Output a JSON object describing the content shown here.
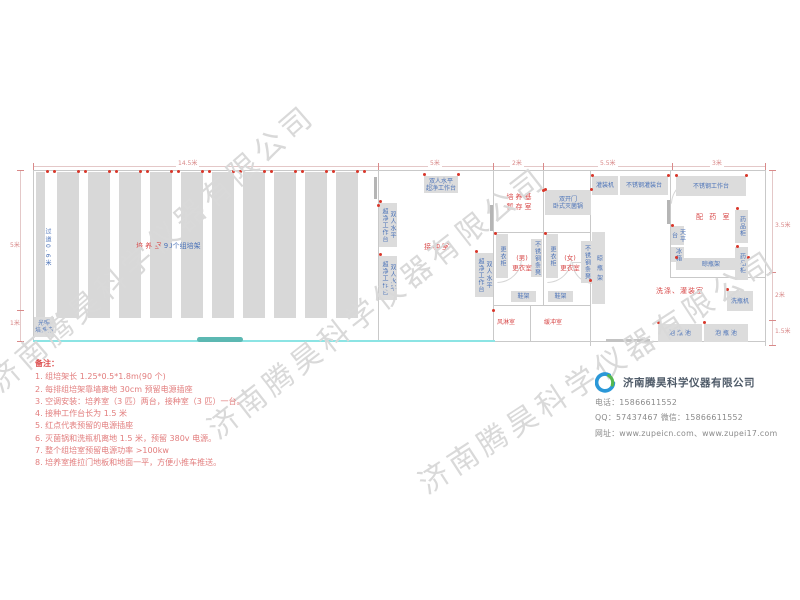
{
  "watermark": {
    "text": "济南腾昊科学仪器有限公司",
    "color": "#d9d9d9",
    "instances": [
      {
        "x": -8,
        "y": 362,
        "angle": -41
      },
      {
        "x": 210,
        "y": 408,
        "angle": -38
      },
      {
        "x": 420,
        "y": 462,
        "angle": -33
      }
    ]
  },
  "plan": {
    "wall_color": "#c9c9c9",
    "walls": [
      {
        "x": 33,
        "y": 170,
        "w": 733,
        "h": 1
      },
      {
        "x": 33,
        "y": 170,
        "w": 1,
        "h": 172
      },
      {
        "x": 765,
        "y": 170,
        "w": 1,
        "h": 176
      },
      {
        "x": 493,
        "y": 341,
        "w": 273,
        "h": 1
      },
      {
        "x": 378,
        "y": 170,
        "w": 1,
        "h": 172
      },
      {
        "x": 493,
        "y": 170,
        "w": 1,
        "h": 172
      },
      {
        "x": 543,
        "y": 170,
        "w": 1,
        "h": 136
      },
      {
        "x": 590,
        "y": 170,
        "w": 1,
        "h": 176
      },
      {
        "x": 670,
        "y": 170,
        "w": 1,
        "h": 108
      },
      {
        "x": 493,
        "y": 232,
        "w": 98,
        "h": 1
      },
      {
        "x": 670,
        "y": 277,
        "w": 96,
        "h": 1
      },
      {
        "x": 493,
        "y": 305,
        "w": 98,
        "h": 1
      },
      {
        "x": 530,
        "y": 305,
        "w": 1,
        "h": 37
      },
      {
        "x": 374,
        "y": 177,
        "w": 3,
        "h": 22,
        "c": "#b5b5b5"
      },
      {
        "x": 490,
        "y": 205,
        "w": 3,
        "h": 26,
        "c": "#b5b5b5"
      },
      {
        "x": 667,
        "y": 200,
        "w": 3,
        "h": 24,
        "c": "#b5b5b5"
      },
      {
        "x": 606,
        "y": 339,
        "w": 44,
        "h": 3,
        "c": "#c3c3c3"
      }
    ],
    "racks": {
      "y": 172,
      "h": 146,
      "color": "#d8d8d8",
      "bars": [
        {
          "x": 36,
          "w": 9
        },
        {
          "x": 57,
          "w": 22
        },
        {
          "x": 88,
          "w": 22
        },
        {
          "x": 119,
          "w": 22
        },
        {
          "x": 150,
          "w": 22
        },
        {
          "x": 181,
          "w": 22
        },
        {
          "x": 212,
          "w": 22
        },
        {
          "x": 243,
          "w": 22
        },
        {
          "x": 274,
          "w": 22
        },
        {
          "x": 305,
          "w": 22
        },
        {
          "x": 336,
          "w": 22
        }
      ]
    },
    "cyan_line": {
      "x": 33,
      "y": 340,
      "w": 462,
      "h": 2,
      "color": "#8ce4e4"
    },
    "door_slide": {
      "x": 197,
      "y": 337,
      "w": 46,
      "h": 5,
      "color": "#5cb8b2"
    },
    "outlet_color": "#d9372b",
    "outlets_top_xs": [
      50,
      81,
      112,
      143,
      174,
      205,
      236,
      267,
      298,
      329,
      360
    ],
    "outlet_dots": [
      [
        380,
        201
      ],
      [
        380,
        254
      ],
      [
        476,
        251
      ],
      [
        424,
        174
      ],
      [
        458,
        174
      ],
      [
        545,
        189
      ],
      [
        591,
        189
      ],
      [
        495,
        233
      ],
      [
        545,
        233
      ],
      [
        592,
        175
      ],
      [
        668,
        175
      ],
      [
        676,
        175
      ],
      [
        746,
        175
      ],
      [
        672,
        225
      ],
      [
        737,
        208
      ],
      [
        737,
        246
      ],
      [
        676,
        257
      ],
      [
        748,
        257
      ],
      [
        727,
        289
      ],
      [
        658,
        322
      ],
      [
        704,
        322
      ],
      [
        543,
        190
      ],
      [
        378,
        205
      ],
      [
        493,
        310
      ],
      [
        590,
        280
      ]
    ],
    "equipment_color": "#dcdcdc",
    "equipment_text_color": "#4a72b8",
    "equipment_h": [
      {
        "x": 424,
        "y": 176,
        "w": 34,
        "h": 17,
        "lines": [
          "双人水平",
          "超净工作台"
        ]
      },
      {
        "x": 545,
        "y": 190,
        "w": 46,
        "h": 25,
        "lines": [
          "双开门",
          "卧式灭菌锅"
        ]
      },
      {
        "x": 592,
        "y": 176,
        "w": 26,
        "h": 19,
        "lines": [
          "灌装机"
        ]
      },
      {
        "x": 620,
        "y": 176,
        "w": 48,
        "h": 19,
        "lines": [
          "不锈钢灌装台"
        ]
      },
      {
        "x": 676,
        "y": 176,
        "w": 70,
        "h": 20,
        "lines": [
          "不锈钢工作台"
        ]
      },
      {
        "x": 676,
        "y": 258,
        "w": 70,
        "h": 12,
        "lines": [
          "晾瓶架"
        ]
      },
      {
        "x": 511,
        "y": 291,
        "w": 25,
        "h": 11,
        "lines": [
          "鞋架"
        ]
      },
      {
        "x": 548,
        "y": 291,
        "w": 25,
        "h": 11,
        "lines": [
          "鞋架"
        ]
      },
      {
        "x": 658,
        "y": 324,
        "w": 44,
        "h": 18,
        "lines": [
          "泡 瓶 池"
        ]
      },
      {
        "x": 704,
        "y": 324,
        "w": 44,
        "h": 18,
        "lines": [
          "泡 瓶 池"
        ]
      },
      {
        "x": 727,
        "y": 291,
        "w": 26,
        "h": 20,
        "lines": [
          "洗瓶机"
        ]
      },
      {
        "x": 34,
        "y": 317,
        "w": 20,
        "h": 20,
        "lines": [
          "光照",
          "培养箱"
        ]
      }
    ],
    "equipment_v": [
      {
        "x": 379,
        "y": 203,
        "w": 18,
        "h": 44,
        "lines": [
          "双人水平",
          "超净工作台"
        ]
      },
      {
        "x": 379,
        "y": 256,
        "w": 18,
        "h": 44,
        "lines": [
          "双人水平",
          "超净工作台"
        ]
      },
      {
        "x": 475,
        "y": 253,
        "w": 18,
        "h": 44,
        "lines": [
          "双人水平",
          "超净工作台"
        ]
      },
      {
        "x": 496,
        "y": 234,
        "w": 12,
        "h": 44,
        "lines": [
          "更衣柜"
        ]
      },
      {
        "x": 546,
        "y": 234,
        "w": 12,
        "h": 44,
        "lines": [
          "更衣柜"
        ]
      },
      {
        "x": 531,
        "y": 239,
        "w": 11,
        "h": 38,
        "lines": [
          "不锈钢条凳"
        ]
      },
      {
        "x": 581,
        "y": 241,
        "w": 11,
        "h": 42,
        "lines": [
          "不锈钢条凳"
        ]
      },
      {
        "x": 592,
        "y": 232,
        "w": 13,
        "h": 72,
        "lines": [
          "晾 瓶 架"
        ]
      },
      {
        "x": 735,
        "y": 210,
        "w": 13,
        "h": 33,
        "lines": [
          "药品柜"
        ]
      },
      {
        "x": 735,
        "y": 247,
        "w": 13,
        "h": 33,
        "lines": [
          "药品柜"
        ]
      },
      {
        "x": 671,
        "y": 226,
        "w": 13,
        "h": 19,
        "lines": [
          "天平台"
        ]
      },
      {
        "x": 671,
        "y": 247,
        "w": 13,
        "h": 15,
        "lines": [
          "冰箱"
        ]
      }
    ],
    "label_color": "#d84a4a",
    "labels": [
      {
        "x": 497,
        "y": 192,
        "w": 46,
        "lines": [
          "培养基",
          "暂存室"
        ],
        "size": 7,
        "ls": 2
      },
      {
        "x": 424,
        "y": 242,
        "lines": [
          "接种室"
        ],
        "size": 7,
        "ls": 2
      },
      {
        "x": 506,
        "y": 253,
        "w": 32,
        "lines": [
          "(男)",
          "更衣室"
        ],
        "size": 6.5
      },
      {
        "x": 554,
        "y": 253,
        "w": 32,
        "lines": [
          "(女)",
          "更衣室"
        ],
        "size": 6.5
      },
      {
        "x": 497,
        "y": 318,
        "lines": [
          "风淋室"
        ],
        "size": 6
      },
      {
        "x": 544,
        "y": 318,
        "lines": [
          "缓冲室"
        ],
        "size": 6
      },
      {
        "x": 696,
        "y": 212,
        "lines": [
          "配 药 室"
        ],
        "size": 7,
        "ls": 2
      },
      {
        "x": 656,
        "y": 286,
        "lines": [
          "洗涤、灌装室"
        ],
        "size": 7,
        "ls": 1
      }
    ],
    "aisle": {
      "x": 42,
      "y": 228,
      "text": "过道0.6米"
    },
    "cultivation": {
      "x": 136,
      "y": 241,
      "red": "培 养 室",
      "blue": "90个组培架",
      "size": 7
    },
    "dims": {
      "color": "#d98a8a",
      "top_line": {
        "x": 33,
        "y": 166,
        "w": 733
      },
      "top_ticks": [
        33,
        378,
        493,
        543,
        672,
        765
      ],
      "top_labels": [
        {
          "t": "14.5米",
          "x": 176
        },
        {
          "t": "5米",
          "x": 428
        },
        {
          "t": "2米",
          "x": 510
        },
        {
          "t": "5.5米",
          "x": 598
        },
        {
          "t": "3米",
          "x": 710
        }
      ],
      "left_line": {
        "x": 20,
        "y": 170,
        "h": 171
      },
      "left_ticks": [
        170,
        310,
        341
      ],
      "left_labels": [
        {
          "t": "5米",
          "y": 240
        },
        {
          "t": "1米",
          "y": 318
        }
      ],
      "right_line": {
        "x": 772,
        "y": 170,
        "h": 176
      },
      "right_ticks": [
        170,
        272,
        320,
        345
      ],
      "right_labels": [
        {
          "t": "3.5米",
          "y": 220
        },
        {
          "t": "2米",
          "y": 290
        },
        {
          "t": "1.5米",
          "y": 326
        }
      ]
    },
    "arcs": [
      {
        "x": 497,
        "y": 281,
        "s": 23,
        "r": "br"
      },
      {
        "x": 547,
        "y": 281,
        "s": 23,
        "r": "br"
      },
      {
        "x": 572,
        "y": 282,
        "s": 20,
        "r": "bl"
      },
      {
        "x": 671,
        "y": 202,
        "s": 22,
        "r": "tl"
      }
    ]
  },
  "notes": {
    "title": "备注：",
    "title_color": "#dd4b4b",
    "color": "#e27d7d",
    "items": [
      "1. 组培架长 1.25*0.5*1.8m(90 个)",
      "2. 每排组培架靠墙离地 30cm 预留电源插座",
      "3. 空调安装：培养室（3 匹）两台，接种室（3 匹）一台。",
      "4. 接种工作台长为 1.5 米",
      "5. 红点代表预留的电源插座",
      "6. 灭菌锅和洗瓶机离地 1.5 米，预留 380v 电源。",
      "7. 整个组培室预留电源功率 >100kw",
      "8. 培养室推拉门地板和地面一平，方便小推车推送。"
    ]
  },
  "company": {
    "name": "济南腾昊科学仪器有限公司",
    "name_color": "#4e5a68",
    "phone_line": "电话：15866611552",
    "qq_line": "QQ：57437467    微信：15866611552",
    "web_line": "网址：www.zupeicn.com、www.zupei17.com",
    "logo_blue": "#2b98d8",
    "logo_green": "#55b84f"
  }
}
